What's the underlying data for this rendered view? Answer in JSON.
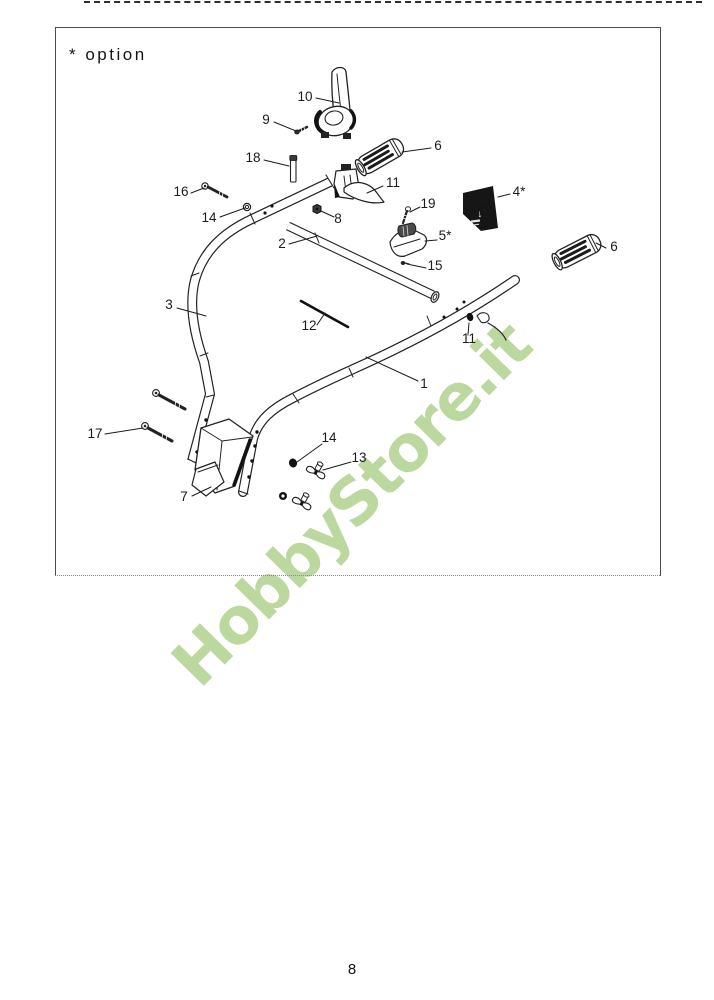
{
  "page": {
    "option_note": "* option",
    "page_number": "8"
  },
  "watermark": {
    "text": "HobbyStore.it",
    "color": "#b8d79a"
  },
  "decal": {
    "label": "START",
    "arrow": "↓"
  },
  "colors": {
    "ink": "#1b1b1b",
    "decal_bg": "#161616"
  },
  "figure": {
    "description_parts": [
      "1",
      "2",
      "3",
      "4*",
      "5*",
      "6",
      "7",
      "8",
      "9",
      "10",
      "11",
      "12",
      "13",
      "14",
      "15",
      "16",
      "17",
      "18",
      "19"
    ],
    "callouts": [
      {
        "label": "10",
        "cx": 305,
        "by": 101,
        "x1": 316,
        "y1": 98,
        "x2": 339,
        "y2": 103
      },
      {
        "label": "9",
        "cx": 266,
        "by": 124,
        "x1": 274,
        "y1": 122,
        "x2": 296,
        "y2": 131
      },
      {
        "label": "18",
        "cx": 253,
        "by": 162,
        "x1": 264,
        "y1": 160,
        "x2": 289,
        "y2": 166
      },
      {
        "label": "6",
        "cx": 438,
        "by": 150,
        "x1": 431,
        "y1": 148,
        "x2": 402,
        "y2": 152
      },
      {
        "label": "16",
        "cx": 181,
        "by": 196,
        "x1": 191,
        "y1": 193,
        "x2": 204,
        "y2": 188
      },
      {
        "label": "14",
        "cx": 209,
        "by": 222,
        "x1": 220,
        "y1": 217,
        "x2": 245,
        "y2": 208
      },
      {
        "label": "11",
        "cx": 393,
        "by": 187,
        "x1": 383,
        "y1": 186,
        "x2": 367,
        "y2": 193
      },
      {
        "label": "8",
        "cx": 338,
        "by": 223,
        "x1": 334,
        "y1": 217,
        "x2": 321,
        "y2": 211
      },
      {
        "label": "19",
        "cx": 428,
        "by": 208,
        "x1": 420,
        "y1": 207,
        "x2": 410,
        "y2": 212
      },
      {
        "label": "4*",
        "cx": 519,
        "by": 196,
        "x1": 510,
        "y1": 194,
        "x2": 498,
        "y2": 197
      },
      {
        "label": "2",
        "cx": 282,
        "by": 248,
        "x1": 289,
        "y1": 244,
        "x2": 317,
        "y2": 236
      },
      {
        "label": "5*",
        "cx": 445,
        "by": 240,
        "x1": 437,
        "y1": 240,
        "x2": 425,
        "y2": 241
      },
      {
        "label": "15",
        "cx": 435,
        "by": 270,
        "x1": 426,
        "y1": 268,
        "x2": 407,
        "y2": 264
      },
      {
        "label": "6",
        "cx": 614,
        "by": 251,
        "x1": 606,
        "y1": 248,
        "x2": 596,
        "y2": 243
      },
      {
        "label": "3",
        "cx": 169,
        "by": 309,
        "x1": 177,
        "y1": 308,
        "x2": 206,
        "y2": 316
      },
      {
        "label": "12",
        "cx": 309,
        "by": 330,
        "x1": 317,
        "y1": 325,
        "x2": 325,
        "y2": 313
      },
      {
        "label": "11",
        "cx": 469,
        "by": 343,
        "x1": 468,
        "y1": 335,
        "x2": 469,
        "y2": 323
      },
      {
        "label": "1",
        "cx": 424,
        "by": 388,
        "x1": 418,
        "y1": 381,
        "x2": 366,
        "y2": 357
      },
      {
        "label": "17",
        "cx": 95,
        "by": 438,
        "x1": 105,
        "y1": 434,
        "x2": 143,
        "y2": 428
      },
      {
        "label": "14",
        "cx": 329,
        "by": 442,
        "x1": 322,
        "y1": 444,
        "x2": 297,
        "y2": 462
      },
      {
        "label": "13",
        "cx": 359,
        "by": 462,
        "x1": 351,
        "y1": 462,
        "x2": 323,
        "y2": 470
      },
      {
        "label": "7",
        "cx": 184,
        "by": 501,
        "x1": 192,
        "y1": 496,
        "x2": 211,
        "y2": 487
      }
    ]
  }
}
